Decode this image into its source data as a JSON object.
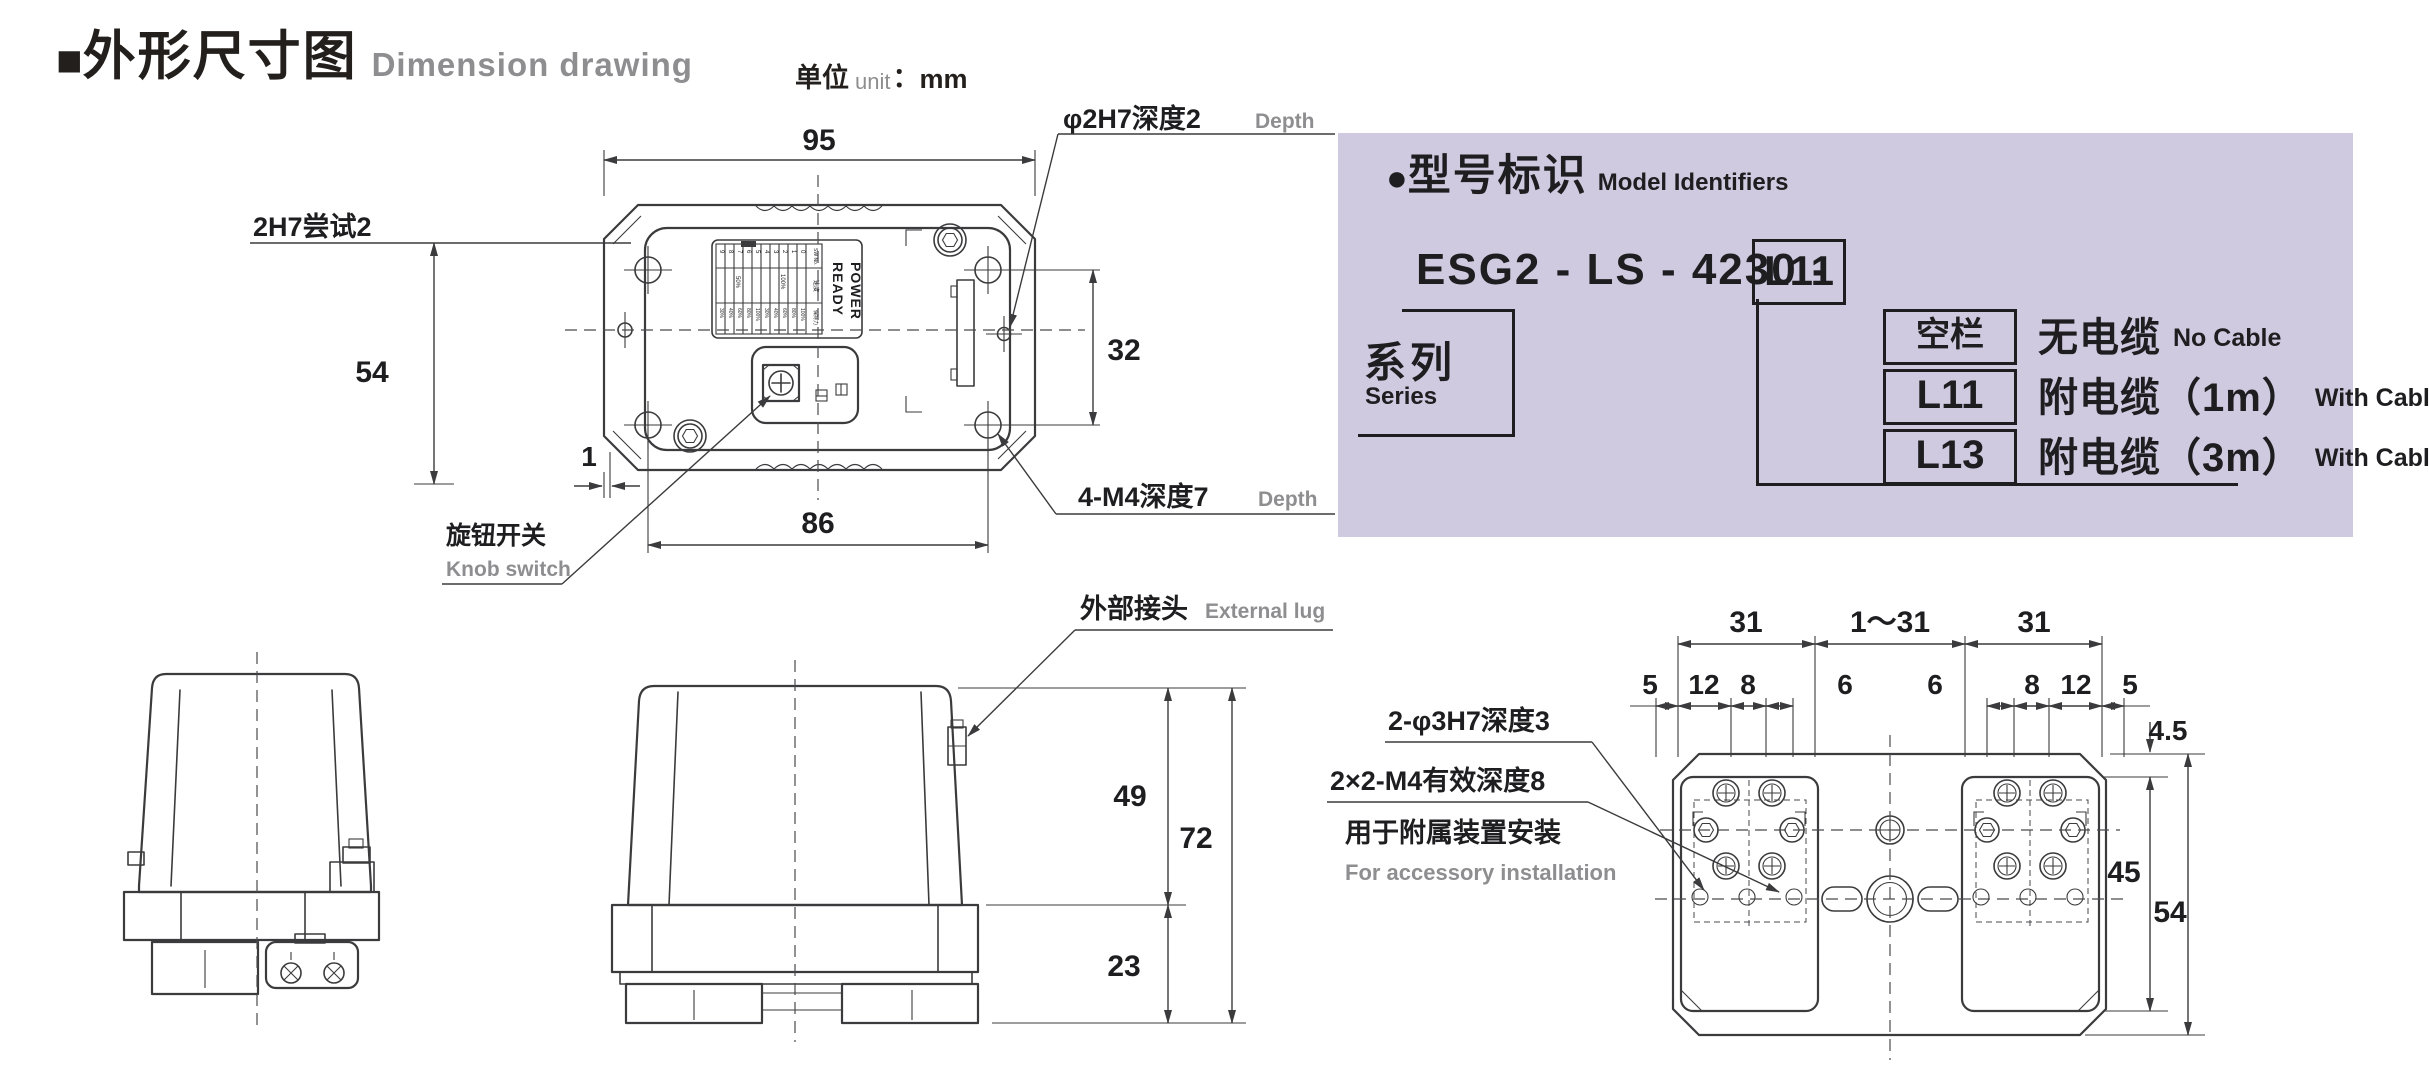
{
  "header": {
    "marker": "■",
    "title_cn": "外形尺寸图",
    "title_en": "Dimension drawing",
    "unit_cn": "单位",
    "unit_en": "unit",
    "unit_colon": "：",
    "unit_value": "mm"
  },
  "colors": {
    "panel_bg": "#d0cae0",
    "ink": "#1e1e20",
    "line": "#3b3b3d",
    "muted": "#8e8e90"
  },
  "top_view": {
    "dim_width": "95",
    "dim_height": "54",
    "dim_hole_v": "32",
    "dim_hole_h": "86",
    "dim_offset": "1",
    "label_pin_left": "2H7尝试2",
    "label_pin_right": "φ2H7深度2",
    "label_pin_right_en": "Depth",
    "label_screws": "4-M4深度7",
    "label_screws_en": "Depth",
    "label_knob": "旋钮开关",
    "label_knob_en": "Knob switch",
    "plate": {
      "ready": "READY",
      "power": "POWER",
      "sw_no": "SW No.",
      "speed_label": "速度",
      "hold_label": "保持力",
      "speed_low": "50%",
      "speed_high": "100%",
      "digits": [
        "0",
        "1",
        "2",
        "3",
        "4",
        "5",
        "6",
        "7",
        "8",
        "9"
      ],
      "hold_values": [
        "30%",
        "40%",
        "60%",
        "80%",
        "100%",
        "30%",
        "40%",
        "60%",
        "80%",
        "100%"
      ]
    }
  },
  "front_view": {
    "label_lug": "外部接头",
    "label_lug_en": "External lug",
    "dim_cover": "49",
    "dim_total": "72",
    "dim_base": "23"
  },
  "bottom_view": {
    "dim_row1": [
      "31",
      "1～31",
      "31"
    ],
    "dim_row2": [
      "5",
      "12",
      "8",
      "6",
      "6",
      "8",
      "12",
      "5"
    ],
    "dim_step": "4.5",
    "dim_pad": "45",
    "dim_total": "54",
    "label_pins": "2-φ3H7深度3",
    "label_m4": "2×2-M4有效深度8",
    "label_m4_cn2": "用于附属装置安装",
    "label_m4_en": "For accessory installation"
  },
  "model_panel": {
    "marker": "●",
    "title_cn": "型号标识",
    "title_en": "Model Identifiers",
    "model_prefix": "ESG2 - LS - 4230 -",
    "model_code": "L11",
    "series_cn": "系列",
    "series_en": "Series",
    "options": [
      {
        "code": "空栏",
        "desc_cn": "无电缆",
        "desc_en": "No Cable"
      },
      {
        "code": "L11",
        "desc_cn": "附电缆（1m）",
        "desc_en": "With Cable"
      },
      {
        "code": "L13",
        "desc_cn": "附电缆（3m）",
        "desc_en": "With Cable"
      }
    ]
  }
}
